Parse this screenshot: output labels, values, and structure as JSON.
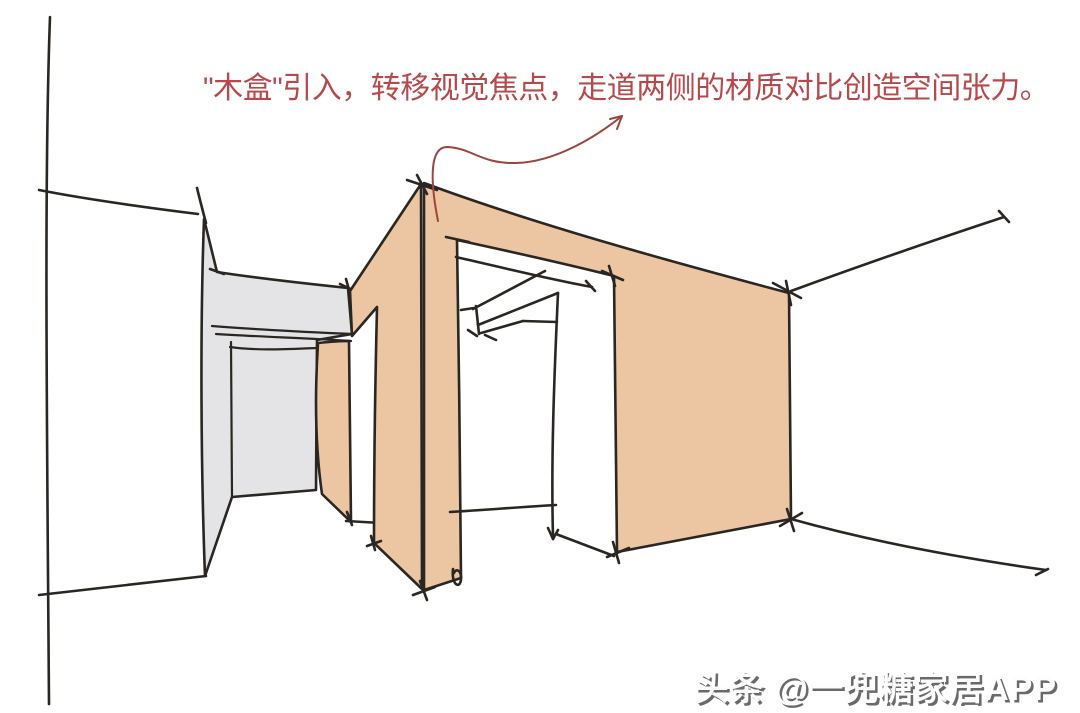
{
  "annotation": {
    "text": "\"木盒\"引入，转移视觉焦点，走道两侧的材质对比创造空间张力。"
  },
  "watermark": {
    "text": "头条 @一兜糖家居APP"
  },
  "sketch": {
    "description": "Hand-drawn perspective sketch of a hallway: a wood-clad box volume with a doorway opening, an existing gray wall on the left, floor and wall guide lines, and a red curved arrow linking the annotation text to the wood box.",
    "elements": [
      "left-wall-lines",
      "gray-wall",
      "wood-box-side-panel",
      "wood-box-left-face",
      "wood-box-front-face",
      "doorway-opening",
      "floor-lines",
      "right-wall-line",
      "annotation-arrow"
    ]
  },
  "colors": {
    "background": "#ffffff",
    "ink": "#2a2622",
    "wood": "#ecc5a2",
    "graywall": "#e4e4e6",
    "annotationred": "#b5494b",
    "arrowred": "#9c443f",
    "watermarkfill": "#fdfdfd",
    "watermarkshadow": "#6a6a6a"
  }
}
